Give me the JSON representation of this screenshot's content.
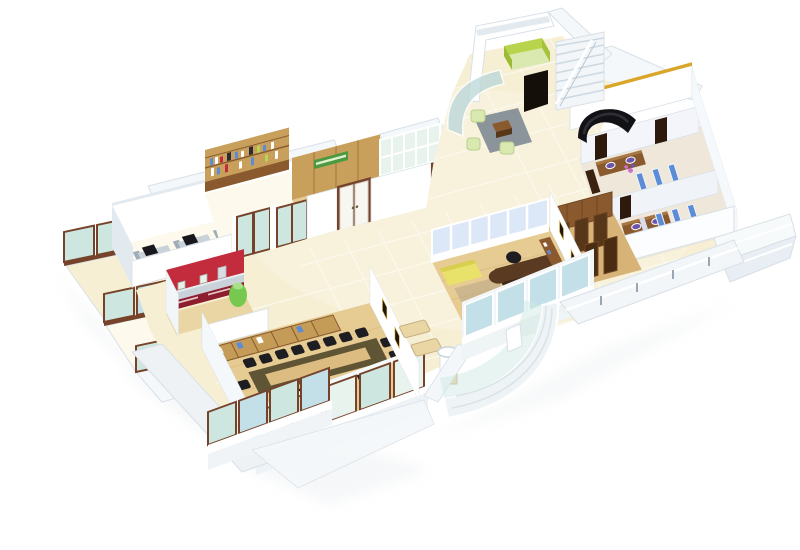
{
  "meta": {
    "type": "3d-isometric-office-floor-plan-render",
    "view": "cutaway-top-down-isometric",
    "background": "#ffffff"
  },
  "palette": {
    "bg": "#ffffff",
    "wall-white": "#ffffff",
    "wall-off": "#f4f8fa",
    "wall-shade": "#e2e9ef",
    "wall-dark": "#c9d4dd",
    "edge": "#d8e0e7",
    "floor-cream": "#f6efd4",
    "floor-cream-hi": "#fdf9ec",
    "floor-wood": "#e6cb93",
    "floor-wood-deep": "#d7b377",
    "frame-brown": "#76432a",
    "glass": "#cde7e0",
    "glass-blue": "#c3e0e8",
    "glass-frost": "#b9d6d8",
    "glass-pale": "#e8f3ee",
    "wood-dark": "#573619",
    "wood-mid": "#8a5a2e",
    "wood-shelf": "#c49c58",
    "wood-pale": "#e9d6a4",
    "panel-wood": "#c8a05c",
    "lime": "#b8d44c",
    "lime-soft": "#d9e9b0",
    "green-sign": "#4c9a3f",
    "jug-green": "#76c84e",
    "red": "#c22c3c",
    "red-dark": "#8c1e2e",
    "steel": "#c9d2d9",
    "steel-dark": "#9fadb9",
    "black": "#17171c",
    "chair-black": "#1d1d22",
    "rug": "#8b939b",
    "blue": "#5c8cd6",
    "blue-pale": "#dce7f7",
    "lavender": "#d9dcec",
    "purple": "#6f55aa",
    "pink": "#cf6fd0",
    "yellow": "#e9e26a",
    "gold": "#d9a62a",
    "shadow": "#b9c3cc",
    "table-olive": "#5f5434",
    "table-inner": "#dcbc80"
  },
  "scene": {
    "rooms": [
      {
        "id": "open-workstations",
        "floor": "cream",
        "items": [
          "4 desks",
          "monitors",
          "black chairs"
        ]
      },
      {
        "id": "library-wall",
        "floor": "cream",
        "items": [
          "wood bookshelf wall with books"
        ]
      },
      {
        "id": "reception-cabin",
        "floor": "wood",
        "items": [
          "green signboard",
          "lime reception desk",
          "book rack"
        ]
      },
      {
        "id": "glass-office",
        "floor": "wood",
        "items": [
          "dark desk",
          "tall bookshelf cabinet",
          "glass partition"
        ]
      },
      {
        "id": "entrance-lobby",
        "floor": "cream-tiles",
        "items": [
          "curved frosted glass",
          "green armchairs",
          "coffee table",
          "gray rug",
          "black curved sofa",
          "staircase",
          "lift-box",
          "black doorway"
        ]
      },
      {
        "id": "pantry",
        "floor": "wood",
        "items": [
          "red walls",
          "steel counter",
          "red cabinets",
          "green water jug"
        ]
      },
      {
        "id": "conference-room",
        "floor": "wood",
        "items": [
          "long table",
          "18 black chairs",
          "credenza",
          "window wall"
        ]
      },
      {
        "id": "utility-room",
        "floor": "cream",
        "items": [
          "washbasin",
          "benches",
          "picture frames"
        ]
      },
      {
        "id": "manager-office",
        "floor": "wood",
        "items": [
          "L desk",
          "black chair",
          "2 guest chairs",
          "yellow sofa",
          "glass partition"
        ]
      },
      {
        "id": "storage-room",
        "floor": "wood",
        "items": [
          "tall brown wardrobes"
        ]
      },
      {
        "id": "washrooms",
        "floor": "tile",
        "items": [
          "2 vanities",
          "4 purple sinks",
          "blue toilet stalls",
          "flowers"
        ]
      },
      {
        "id": "balcony-left",
        "items": [
          "stepped glass railing panels"
        ]
      },
      {
        "id": "terrace-right",
        "items": [
          "white stepped ledge",
          "railing"
        ]
      },
      {
        "id": "atrium-front",
        "items": [
          "curved glass facade"
        ]
      }
    ],
    "counts": {
      "workstation_desks": 4,
      "conference_chairs": 18,
      "washroom_sinks": 4,
      "conference_window_panes": 5
    }
  }
}
